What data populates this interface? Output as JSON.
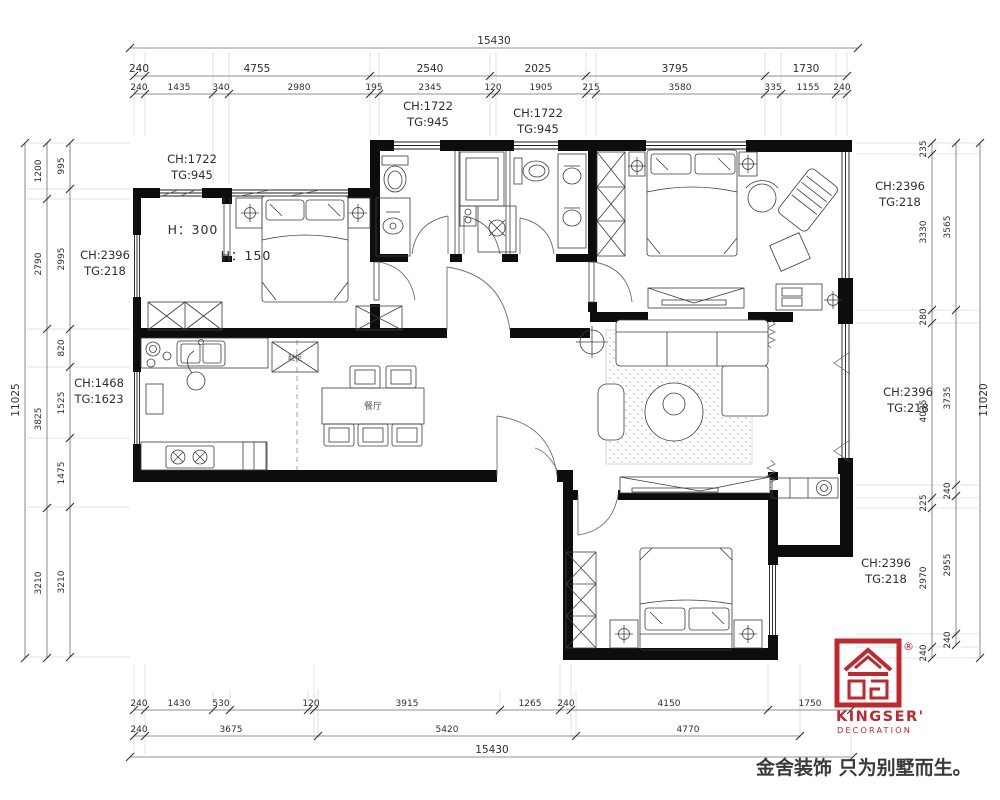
{
  "dims": {
    "top": {
      "total": "15430",
      "r2": [
        "240",
        "4755",
        "2540",
        "2025",
        "3795",
        "1730"
      ],
      "r3": [
        "240",
        "1435",
        "340",
        "2980",
        "195",
        "2345",
        "120",
        "1905",
        "215",
        "3580",
        "335",
        "1155",
        "240"
      ]
    },
    "bottom": {
      "r1": [
        "240",
        "1430",
        "530",
        "120",
        "3915",
        "1265",
        "240",
        "4150",
        "1750"
      ],
      "r2": [
        "240",
        "3675",
        "5420",
        "4770"
      ],
      "total": "15430"
    },
    "left": {
      "total": "11025",
      "mid": [
        "1200",
        "2790",
        "3825",
        "3210"
      ],
      "inner": [
        "995",
        "2995",
        "820",
        "1525",
        "1475",
        "3210"
      ]
    },
    "right": {
      "total": "11020",
      "mid": [
        "3565",
        "3735",
        "240",
        "2955",
        "240"
      ],
      "inner": [
        "235",
        "3330",
        "280",
        "4035",
        "225",
        "2970",
        "240"
      ]
    }
  },
  "labels": {
    "ch": [
      {
        "ch": "CH:1722",
        "tg": "TG:945"
      },
      {
        "ch": "CH:1722",
        "tg": "TG:945"
      },
      {
        "ch": "CH:1722",
        "tg": "TG:945"
      },
      {
        "ch": "CH:2396",
        "tg": "TG:218"
      },
      {
        "ch": "CH:2396",
        "tg": "TG:218"
      },
      {
        "ch": "CH:1468",
        "tg": "TG:1623"
      },
      {
        "ch": "CH:2396",
        "tg": "TG:218"
      },
      {
        "ch": "CH:2396",
        "tg": "TG:218"
      }
    ],
    "h300": "H：300",
    "h150": "H：150",
    "dining": "餐厅",
    "shoe": "鞋柜"
  },
  "brand": {
    "name": "KINGSER'",
    "sub": "DECORATION",
    "reg": "®",
    "slogan": "金舍装饰 只为别墅而生。",
    "color": "#c1272d"
  }
}
